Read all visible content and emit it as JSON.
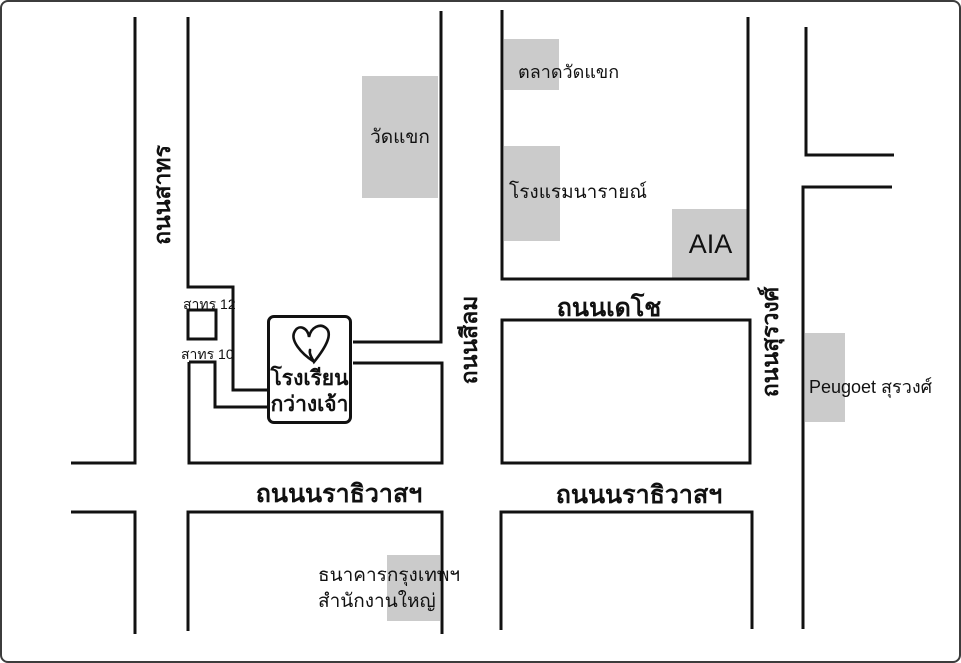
{
  "map": {
    "roads": {
      "sathon": {
        "label": "ถนนสาทร"
      },
      "silom": {
        "label": "ถนนสีลม"
      },
      "decho": {
        "label": "ถนนเดโช"
      },
      "surawong": {
        "label": "ถนนสุรวงศ์"
      },
      "narathiwat_west": {
        "label": "ถนนนราธิวาสฯ"
      },
      "narathiwat_east": {
        "label": "ถนนนราธิวาสฯ"
      },
      "soi_12": {
        "label": "สาทร 12"
      },
      "soi_10": {
        "label": "สาทร 10"
      }
    },
    "places": {
      "wat_khaek": {
        "label": "วัดแขก"
      },
      "talat_wat_khaek": {
        "label": "ตลาดวัดแขก"
      },
      "narai_hotel": {
        "label": "โรงแรมนารายณ์"
      },
      "aia": {
        "label": "AIA"
      },
      "peugeot": {
        "label": "Peugoet สุรวงศ์"
      },
      "bangkok_bank": {
        "line1": "ธนาคารกรุงเทพฯ",
        "line2": "สำนักงานใหญ่"
      },
      "school": {
        "line1": "โรงเรียน",
        "line2": "กว่างเจ้า"
      }
    },
    "colors": {
      "background": "#ffffff",
      "road_line": "#111111",
      "building_fill": "#cbcbcb",
      "text": "#111111",
      "frame_border": "#3c3c3c"
    }
  }
}
